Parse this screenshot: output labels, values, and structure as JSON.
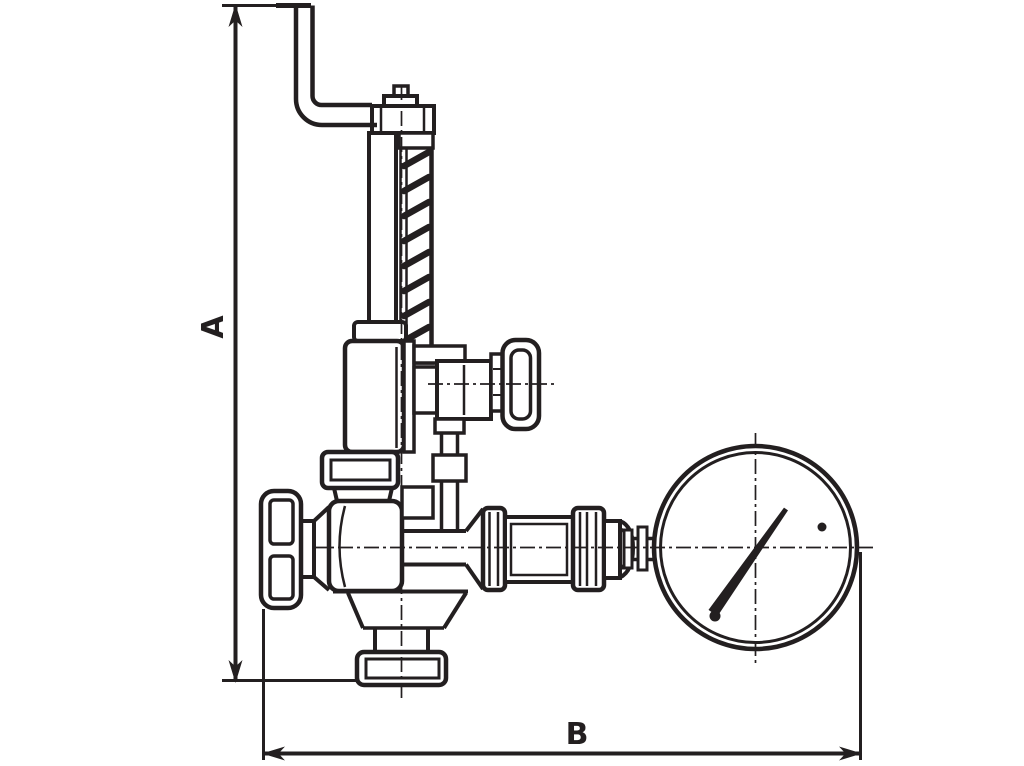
{
  "page": {
    "width": 1024,
    "height": 766,
    "background": "#ffffff"
  },
  "drawing": {
    "type": "technical-outline-drawing",
    "line_color": "#231f20",
    "fill_color": "#ffffff",
    "dimension_a_label": "A",
    "dimension_b_label": "B"
  }
}
